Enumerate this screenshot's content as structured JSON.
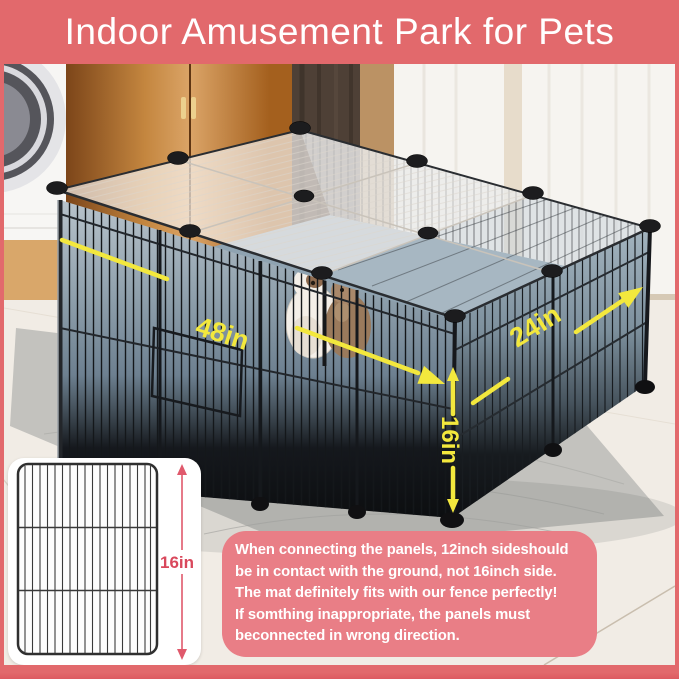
{
  "banner": {
    "title": "Indoor Amusement Park for Pets"
  },
  "scene": {
    "labels": {
      "width": "48in",
      "depth": "24in",
      "height": "16in"
    }
  },
  "panel_card": {
    "height_label": "16in"
  },
  "note": {
    "lines": [
      "When connecting the panels, 12inch sideshould",
      "be in contact with the ground, not 16inch side.",
      "The mat definitely fits with our fence perfectly!",
      "If somthing inappropriate, the panels must",
      "beconnected in wrong direction."
    ]
  },
  "colors": {
    "frame_pink": "#e2696c",
    "note_pink": "#e97e86",
    "accent_red": "#d9485c",
    "annotation_yellow": "#f3e83d"
  }
}
